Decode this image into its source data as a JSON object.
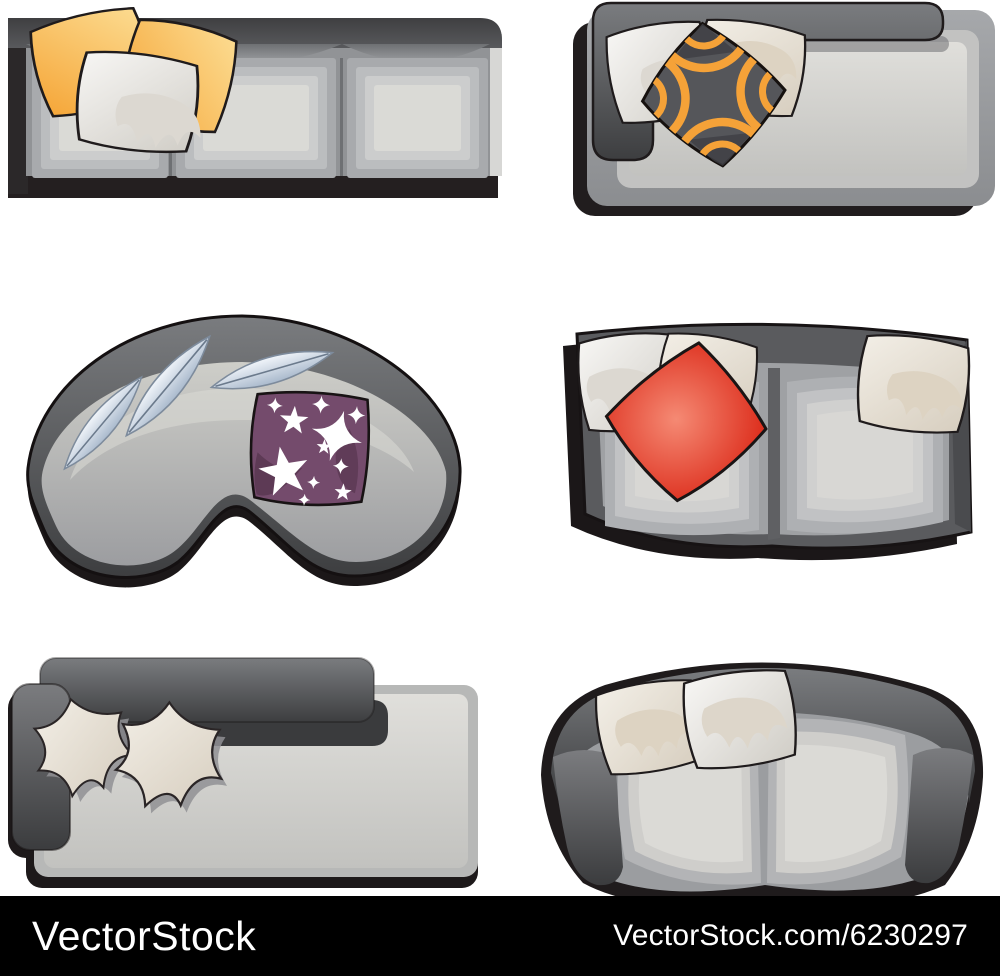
{
  "watermark_bar": {
    "brand": "VectorStock",
    "url": "VectorStock.com/6230297",
    "background": "#000000",
    "text_color": "#ffffff"
  },
  "palette": {
    "shadow_black": "#201c1d",
    "outline_black": "#1a1516",
    "sofa_back_dark": "#47484a",
    "sofa_body_gray": "#919396",
    "cushion_light": "#d9d8d4",
    "pillow_yellow": "#f5a838",
    "pillow_yellow_light": "#fcdd93",
    "pillow_white": "#f6f5f3",
    "pillow_cream": "#efe9df",
    "pillow_drip": "#dcd4c6",
    "pillow_red": "#dc2b1a",
    "pillow_red_light": "#f58a74",
    "pillow_purple": "#744b6c",
    "pillow_purple_dark": "#5d3a55",
    "pattern_orange": "#f5a238",
    "pattern_gray": "#55565a",
    "pattern_gray_dark": "#3e3f43",
    "feather_blue": "#a9b9cc",
    "star_white": "#ffffff"
  },
  "items": [
    {
      "name": "three-seat-straight-sofa",
      "description": "Straight three-seat sofa top view with two yellow pillows and one white pillow"
    },
    {
      "name": "corner-back-daybed-sofa",
      "description": "Daybed sofa top view with L-shaped backrest, two white pillows and a black-orange patterned pillow"
    },
    {
      "name": "kidney-curved-sofa",
      "description": "Curved kidney-shaped sofa top view with three leaf-shaped pillows and a purple star pillow"
    },
    {
      "name": "curved-two-seat-sofa",
      "description": "Curved two-seat sofa top view with three cream pillows and one red pillow"
    },
    {
      "name": "low-back-daybed-sofa",
      "description": "Straight daybed sofa top view with two cream petal-shaped pillows"
    },
    {
      "name": "rounded-two-seat-sofa",
      "description": "Rounded curved two-seat sofa top view with two cream pillows"
    }
  ]
}
